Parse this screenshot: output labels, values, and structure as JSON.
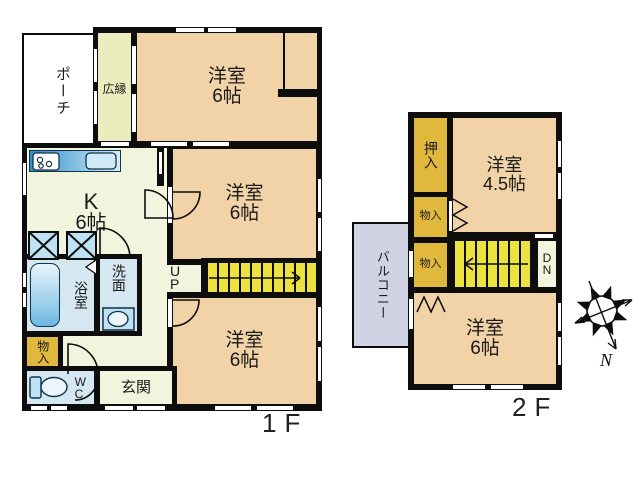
{
  "title": "house-floor-plan",
  "colors": {
    "wall": "#0d0d0d",
    "peach": "#f2d3a7",
    "cream": "#f3f4de",
    "pale_green": "#ecedbe",
    "closet_yellow": "#e0b83e",
    "stair_yellow": "#ece23e",
    "water_blue": "#d5e7f0",
    "fixture_blue": "#9fd0e8",
    "balcony_gray": "#cfd3e3"
  },
  "floor1": {
    "floor_label": "1F",
    "stairs": {
      "label_line1": "U",
      "label_line2": "P"
    },
    "rooms": {
      "porch": {
        "label": "ポーチ"
      },
      "hiroen": {
        "label": "広縁"
      },
      "bedroom_top": {
        "name": "洋室",
        "size": "6帖"
      },
      "bedroom_mid": {
        "name": "洋室",
        "size": "6帖"
      },
      "bedroom_bottom": {
        "name": "洋室",
        "size": "6帖"
      },
      "kitchen": {
        "name": "K",
        "size": "6帖"
      },
      "bath": {
        "label": "浴室"
      },
      "washroom": {
        "label": "洗面"
      },
      "storage": {
        "label": "物入"
      },
      "wc": {
        "line1": "W",
        "line2": "C"
      },
      "entrance": {
        "label": "玄関"
      }
    }
  },
  "floor2": {
    "floor_label": "2F",
    "stairs": {
      "label_line1": "D",
      "label_line2": "N"
    },
    "rooms": {
      "oshiire": {
        "label": "押入"
      },
      "bedroom_45": {
        "name": "洋室",
        "size": "4.5帖"
      },
      "storage1": {
        "label": "物入"
      },
      "storage2": {
        "label": "物入"
      },
      "balcony": {
        "label": "バルコニー"
      },
      "bedroom_6": {
        "name": "洋室",
        "size": "6帖"
      }
    }
  },
  "compass": {
    "north_label": "N"
  }
}
